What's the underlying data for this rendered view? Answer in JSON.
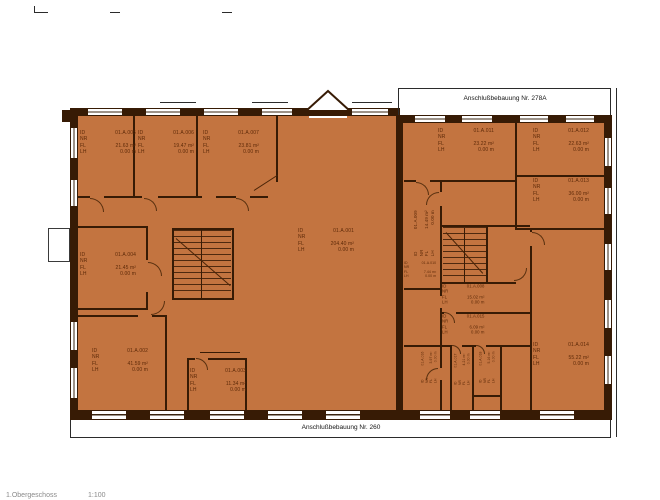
{
  "plan": {
    "annotation_top": "Anschlußbebauung Nr. 278A",
    "annotation_bottom": "Anschlußbebauung Nr. 260",
    "corner_note": "1.Obergeschoss",
    "corner_scale": "1:100",
    "field_labels": {
      "id": "ID",
      "nr": "NR",
      "fl": "FL",
      "lh": "LH"
    },
    "colors": {
      "floor_fill": "#C37440",
      "wall": "#371B05",
      "room_text": "#5E2A08"
    },
    "rooms": [
      {
        "id": "01.A.005",
        "area": "21.63 m²",
        "clear_height": "0.00 m",
        "x": 80,
        "y": 130,
        "style": "h"
      },
      {
        "id": "01.A.006",
        "area": "19.47 m²",
        "clear_height": "0.00 m",
        "x": 138,
        "y": 130,
        "style": "h"
      },
      {
        "id": "01.A.007",
        "area": "23.81 m²",
        "clear_height": "0.00 m",
        "x": 203,
        "y": 130,
        "style": "h"
      },
      {
        "id": "01.A.001",
        "area": "204.40 m²",
        "clear_height": "0.00 m",
        "x": 298,
        "y": 228,
        "style": "h"
      },
      {
        "id": "01.A.004",
        "area": "21.45 m²",
        "clear_height": "0.00 m",
        "x": 80,
        "y": 252,
        "style": "h"
      },
      {
        "id": "01.A.002",
        "area": "41.59 m²",
        "clear_height": "0.00 m",
        "x": 92,
        "y": 348,
        "style": "h"
      },
      {
        "id": "01.A.003",
        "area": "11.34 m²",
        "clear_height": "0.00 m",
        "x": 190,
        "y": 368,
        "style": "h"
      },
      {
        "id": "01.A.011",
        "area": "23.22 m²",
        "clear_height": "0.00 m",
        "x": 438,
        "y": 128,
        "style": "h"
      },
      {
        "id": "01.A.012",
        "area": "22.63 m²",
        "clear_height": "0.00 m",
        "x": 533,
        "y": 128,
        "style": "h"
      },
      {
        "id": "01.A.013",
        "area": "36.00 m²",
        "clear_height": "0.00 m",
        "x": 533,
        "y": 178,
        "style": "h"
      },
      {
        "id": "01.A.014",
        "area": "55.22 m²",
        "clear_height": "0.00 m",
        "x": 533,
        "y": 342,
        "style": "h"
      },
      {
        "id": "01.A.008",
        "area": "15.02 m²",
        "clear_height": "0.00 m",
        "x": 442,
        "y": 284,
        "style": "hsm"
      },
      {
        "id": "01.A.015",
        "area": "6.09 m²",
        "clear_height": "0.00 m",
        "x": 442,
        "y": 314,
        "style": "hsm"
      },
      {
        "id": "01.A.010",
        "area": "7.44 m²",
        "clear_height": "0.00 m",
        "x": 404,
        "y": 261,
        "style": "hxs"
      },
      {
        "id": "01.A.009",
        "area": "14.49 m²",
        "clear_height": "0.00 m",
        "x": 401,
        "y": 222,
        "style": "v90"
      },
      {
        "id": "01.A.016",
        "area": "3.97 m²",
        "clear_height": "0.00 m",
        "x": 408,
        "y": 356,
        "style": "vsm"
      },
      {
        "id": "01.A.017",
        "area": "4.21 m²",
        "clear_height": "0.00 m",
        "x": 441,
        "y": 358,
        "style": "vsm"
      },
      {
        "id": "01.A.018",
        "area": "5.16 m²",
        "clear_height": "0.00 m",
        "x": 466,
        "y": 356,
        "style": "vsm"
      }
    ]
  }
}
